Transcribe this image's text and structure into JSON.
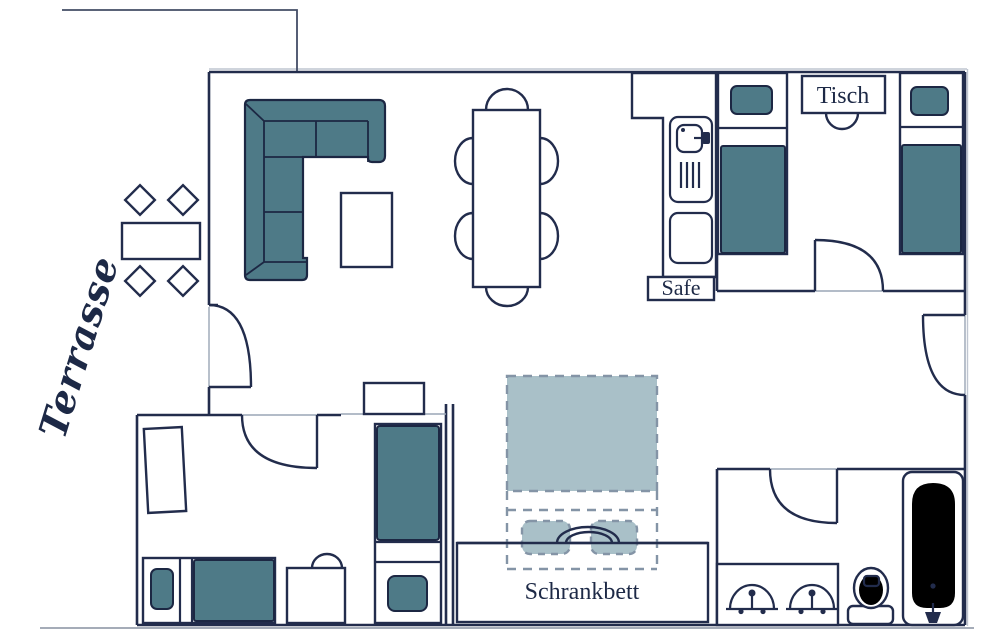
{
  "title": "Apartment floor plan",
  "labels": {
    "terrace": "Terrasse",
    "bedside_table": "Tisch",
    "safe": "Safe",
    "wall_bed": "Schrankbett"
  },
  "colors": {
    "wall_line": "#222c4c",
    "upholstery_teal": "#4e7a87",
    "wall_bed_teal": "#a9c0c8",
    "dash_gray": "#8494a6",
    "threshold_gray": "#9aa5b5",
    "ground_gray": "#98a0ae",
    "background": "#ffffff",
    "text": "#1d2946"
  },
  "rooms": {
    "terrace": [
      "terrace-table",
      "four-terrace-chairs"
    ],
    "living_room": [
      "corner-sofa",
      "coffee-table",
      "dining-table-with-six-chairs",
      "wall-shelf"
    ],
    "kitchen": [
      "kitchen-counter",
      "sink-unit",
      "lower-cabinet",
      "safe"
    ],
    "bedroom_top_right": [
      "single-bed",
      "single-bed",
      "bedside-table",
      "chair"
    ],
    "bedroom_bottom_left": [
      "wardrobe",
      "single-bed",
      "desk-with-chair",
      "single-bed"
    ],
    "wall_bed_niche": [
      "folding-wall-bed",
      "two-pillows",
      "cabinet"
    ],
    "bathroom": [
      "double-washbasin",
      "toilet",
      "bathtub"
    ]
  }
}
